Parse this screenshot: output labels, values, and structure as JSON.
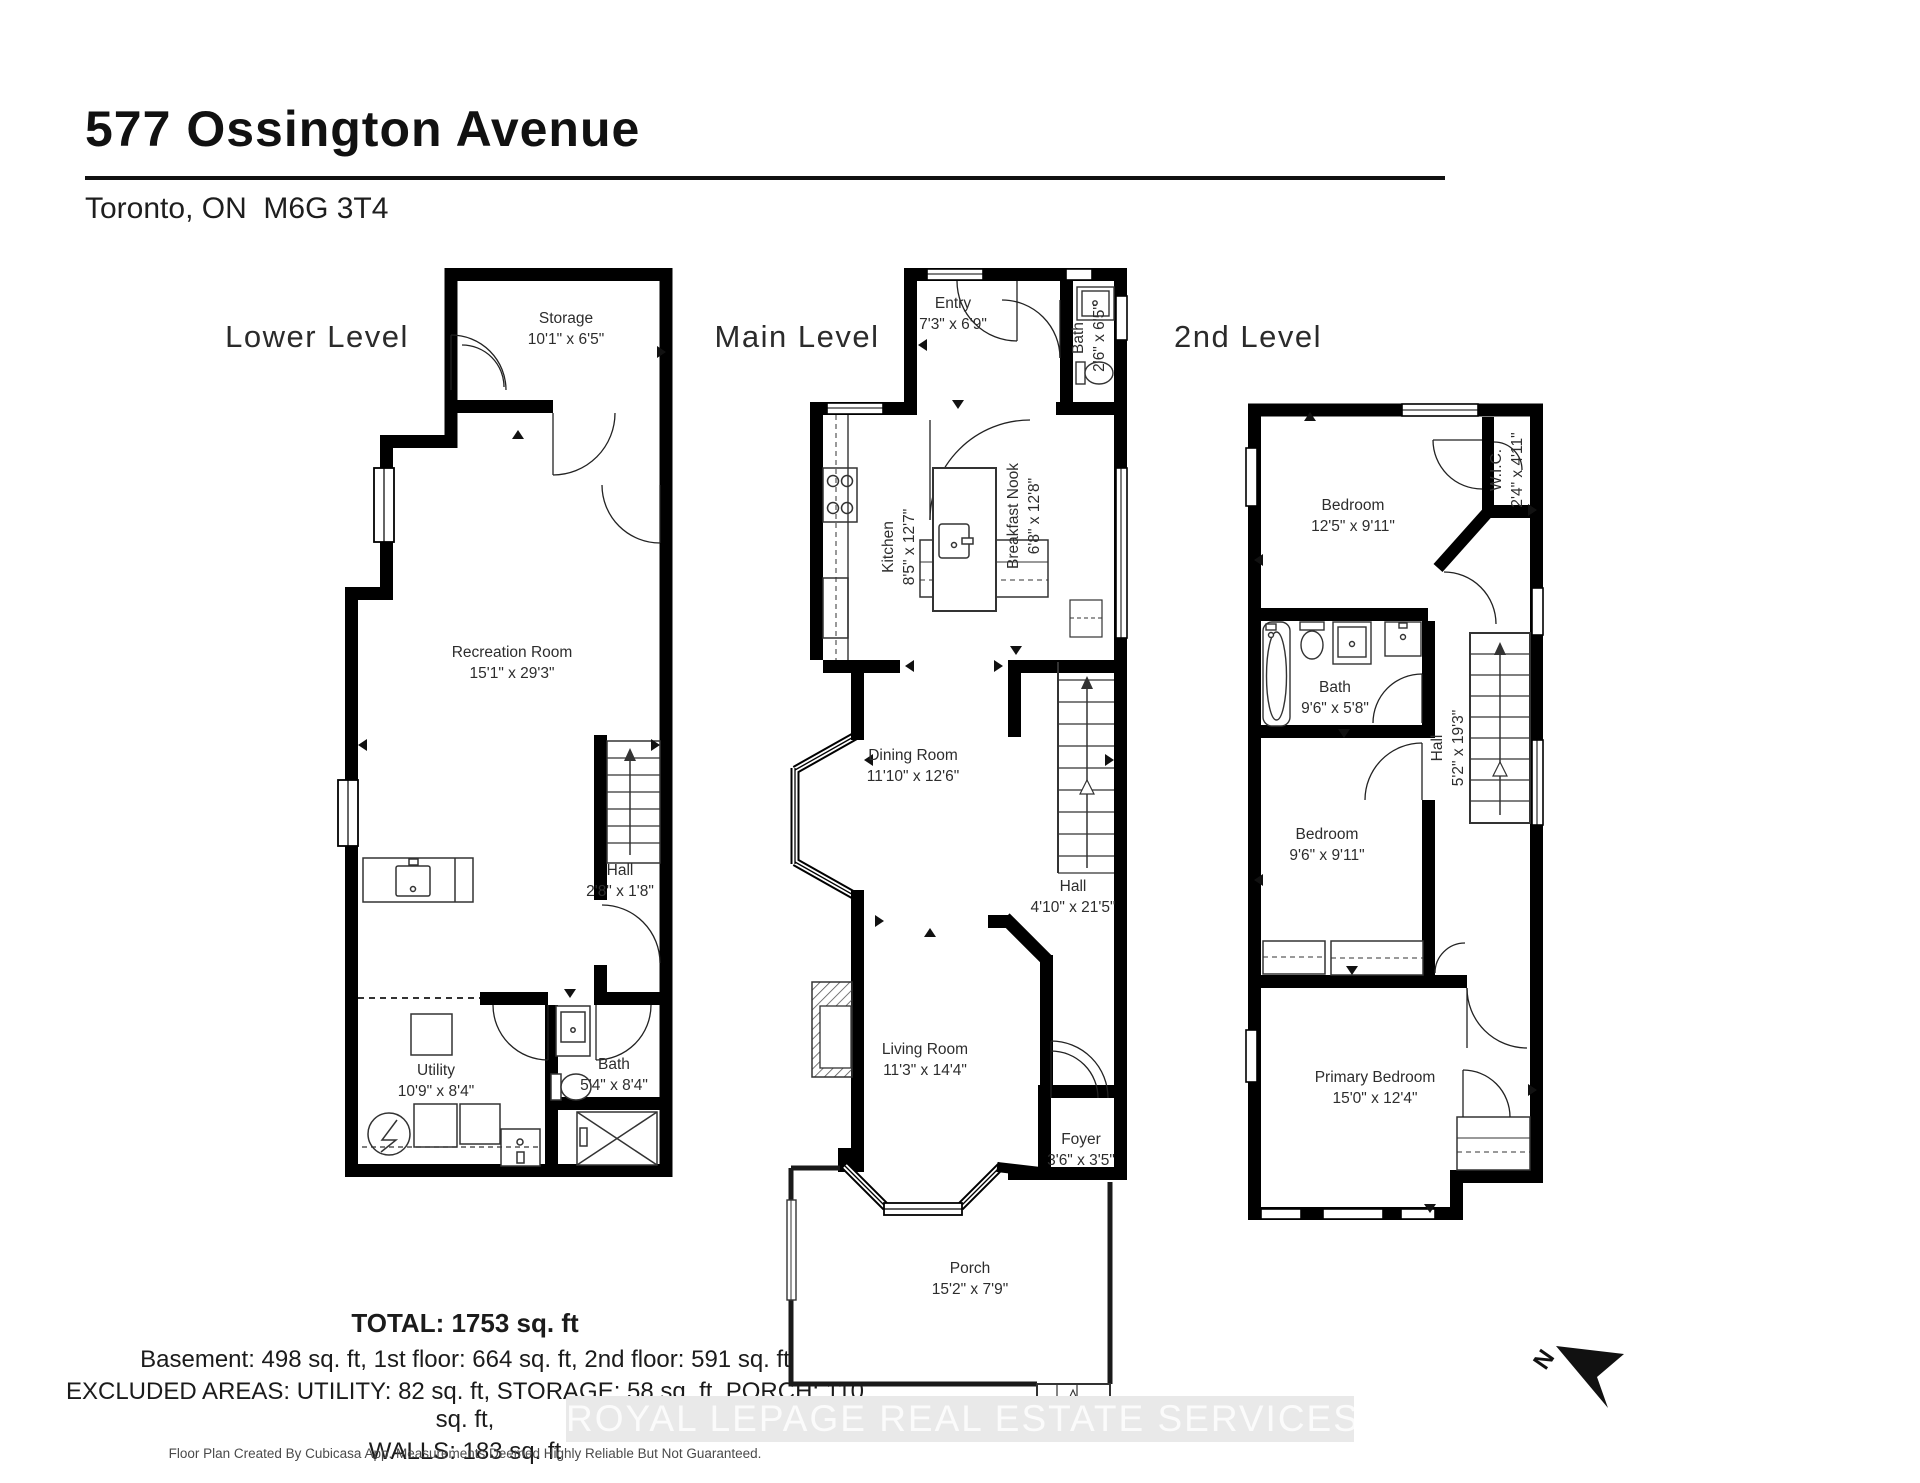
{
  "header": {
    "title": "577 Ossington Avenue",
    "subtitle": "Toronto, ON  M6G 3T4"
  },
  "levels": {
    "lower": {
      "label": "Lower Level",
      "rooms": {
        "storage": {
          "name": "Storage",
          "dims": "10'1\" x 6'5\""
        },
        "recreation": {
          "name": "Recreation Room",
          "dims": "15'1\" x 29'3\""
        },
        "hall": {
          "name": "Hall",
          "dims": "2'8\" x 1'8\""
        },
        "utility": {
          "name": "Utility",
          "dims": "10'9\" x 8'4\""
        },
        "bath": {
          "name": "Bath",
          "dims": "5'4\" x 8'4\""
        }
      }
    },
    "main": {
      "label": "Main Level",
      "rooms": {
        "entry": {
          "name": "Entry",
          "dims": "7'3\" x 6'9\""
        },
        "bath": {
          "name": "Bath",
          "dims": "2'6\" x 6'5\""
        },
        "kitchen": {
          "name": "Kitchen",
          "dims": "8'5\" x 12'7\""
        },
        "nook": {
          "name": "Breakfast Nook",
          "dims": "6'8\" x 12'8\""
        },
        "dining": {
          "name": "Dining Room",
          "dims": "11'10\" x 12'6\""
        },
        "hall": {
          "name": "Hall",
          "dims": "4'10\" x 21'5\""
        },
        "living": {
          "name": "Living Room",
          "dims": "11'3\" x 14'4\""
        },
        "foyer": {
          "name": "Foyer",
          "dims": "3'6\" x 3'5\""
        },
        "porch": {
          "name": "Porch",
          "dims": "15'2\" x 7'9\""
        }
      }
    },
    "second": {
      "label": "2nd Level",
      "rooms": {
        "bedroom1": {
          "name": "Bedroom",
          "dims": "12'5\" x 9'11\""
        },
        "wic": {
          "name": "W.I.C.",
          "dims": "2'4\" x 4'11\""
        },
        "bath": {
          "name": "Bath",
          "dims": "9'6\" x 5'8\""
        },
        "hall": {
          "name": "Hall",
          "dims": "5'2\" x 19'3\""
        },
        "bedroom2": {
          "name": "Bedroom",
          "dims": "9'6\" x 9'11\""
        },
        "primary": {
          "name": "Primary Bedroom",
          "dims": "15'0\" x 12'4\""
        }
      }
    }
  },
  "summary": {
    "total": "TOTAL: 1753 sq. ft",
    "line1": "Basement: 498 sq. ft, 1st floor: 664 sq. ft, 2nd floor: 591 sq. ft",
    "line2": "EXCLUDED AREAS: UTILITY: 82 sq. ft, STORAGE: 58 sq. ft, PORCH: 110 sq. ft,",
    "line3": "WALLS: 183 sq. ft"
  },
  "watermark": "ROYAL LEPAGE REAL ESTATE SERVICES LTD., Brokerage",
  "footer": "Floor Plan Created By Cubicasa App. Measurements Deemed Highly Reliable But Not Guaranteed.",
  "compass": {
    "label": "N"
  },
  "colors": {
    "wall": "#000000",
    "line": "#333333",
    "text": "#2d2d2d"
  }
}
